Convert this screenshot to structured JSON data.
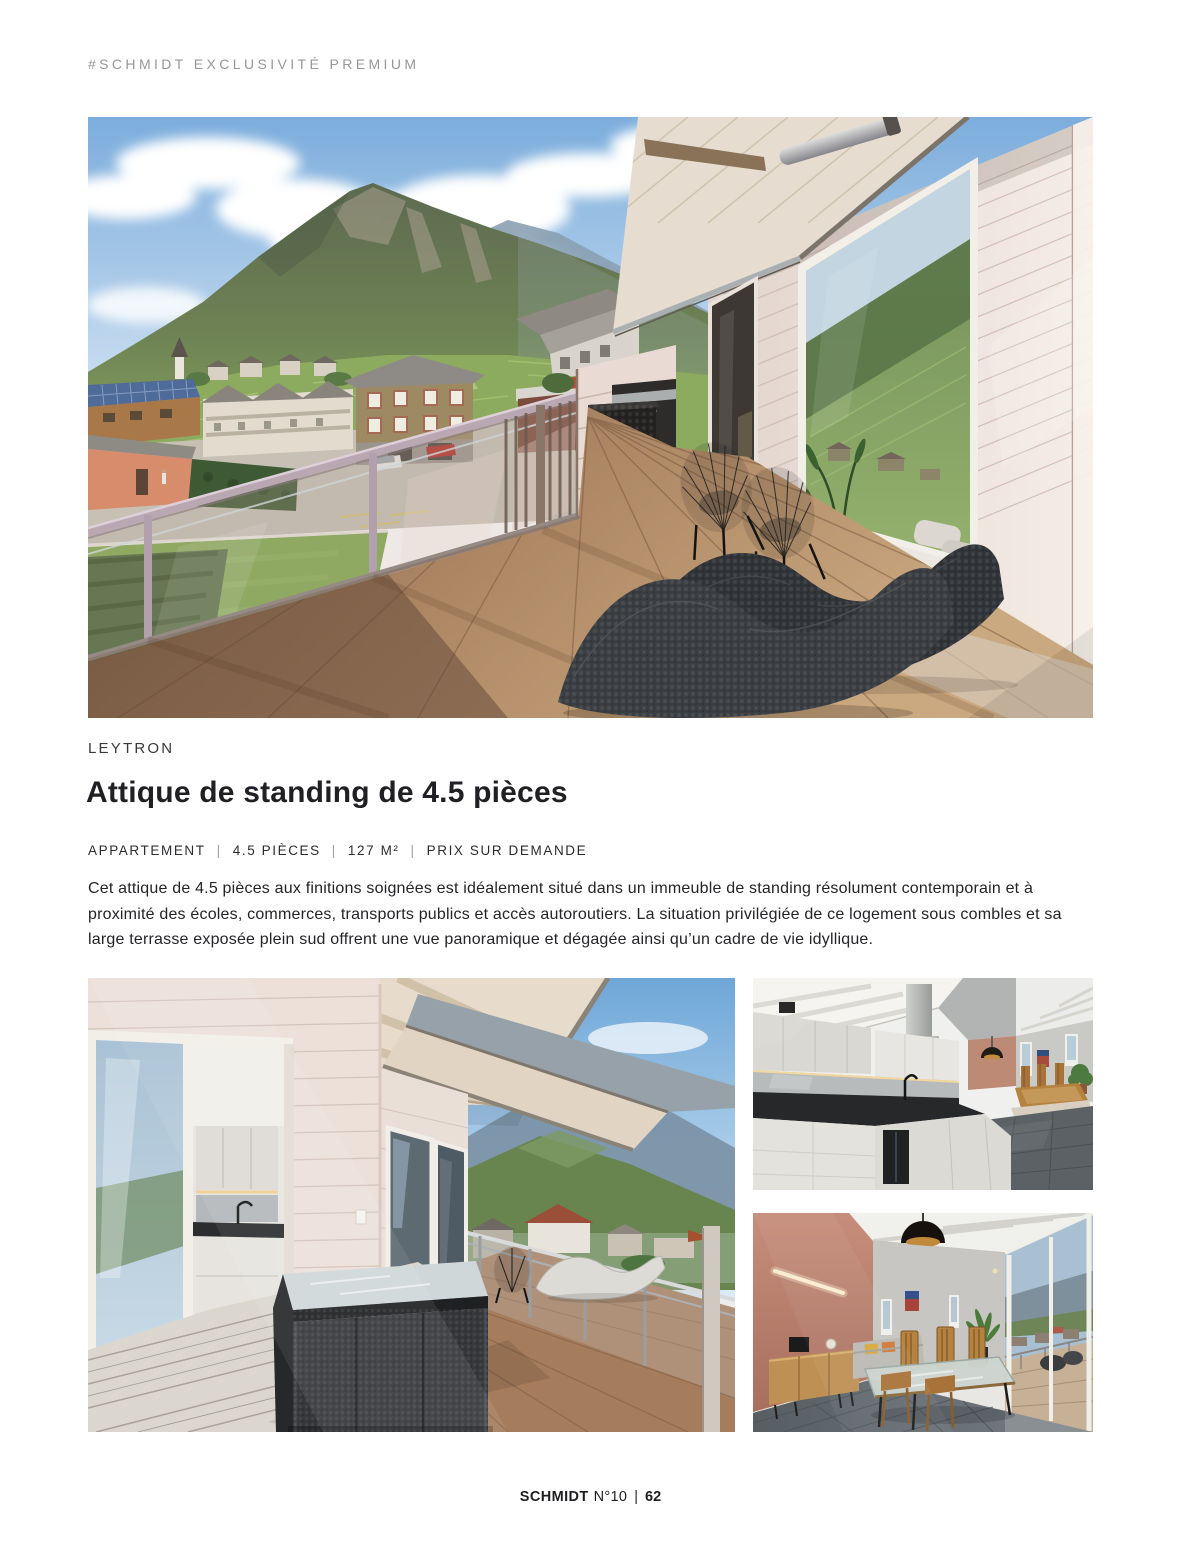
{
  "header": {
    "eyebrow": "#SCHMIDT EXCLUSIVITÉ PREMIUM"
  },
  "listing": {
    "location": "LEYTRON",
    "title": "Attique de standing de 4.5 pièces",
    "meta": {
      "separator": "|",
      "items": [
        "APPARTEMENT",
        "4.5 PIÈCES",
        "127 M²",
        "PRIX SUR DEMANDE"
      ]
    },
    "description": "Cet attique de 4.5 pièces aux finitions soignées est idéalement situé dans un immeuble de standing résolument contemporain et à proximité des écoles, commerces, transports publics et accès autoroutiers. La situation privilégiée de ce logement sous combles et sa large terrasse exposée plein sud offrent une vue panoramique et dégagée ainsi qu’un cadre de vie idyllique."
  },
  "footer": {
    "brand": "SCHMIDT",
    "issue": "N°10",
    "separator": "|",
    "page": "62"
  },
  "colors": {
    "page_bg": "#ffffff",
    "eyebrow_text": "#97979b",
    "heading_text": "#202024",
    "body_text": "#242428",
    "terracotta_accent": "#bd8a75",
    "sky_blue": "#8ab4de",
    "deck_wood": "#a97f5f",
    "railing_metal": "#b9a8b2"
  }
}
